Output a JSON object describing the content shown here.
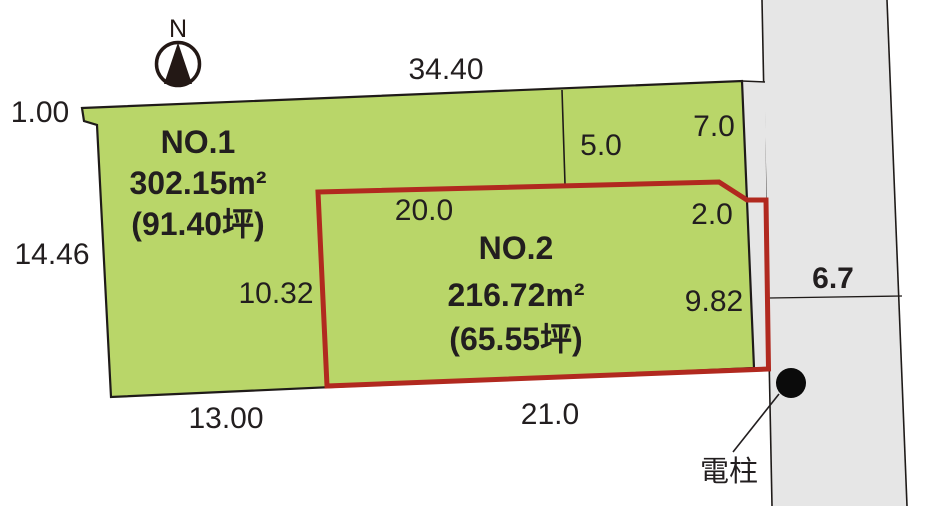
{
  "compass": {
    "north_label": "N"
  },
  "plots": {
    "no1": {
      "name": "NO.1",
      "area_m2": "302.15m²",
      "area_tsubo": "(91.40坪)"
    },
    "no2": {
      "name": "NO.2",
      "area_m2": "216.72m²",
      "area_tsubo": "(65.55坪)"
    }
  },
  "dimensions": {
    "top_width": "34.40",
    "top_left_offset": "1.00",
    "left_depth": "14.46",
    "upper_right_a": "5.0",
    "upper_right_b": "7.0",
    "no2_top_width": "20.0",
    "no2_right_offset": "2.0",
    "no2_left_depth": "10.32",
    "no2_right_depth": "9.82",
    "bottom_left_width": "13.00",
    "no2_bottom_width": "21.0",
    "road_width": "6.7"
  },
  "annotations": {
    "utility_pole_label": "電柱"
  },
  "colors": {
    "plot_fill": "#b9d669",
    "no2_outline": "#b1291f",
    "road_fill": "#e6e6e6",
    "line": "#1f1b19",
    "ink": "#231815"
  }
}
